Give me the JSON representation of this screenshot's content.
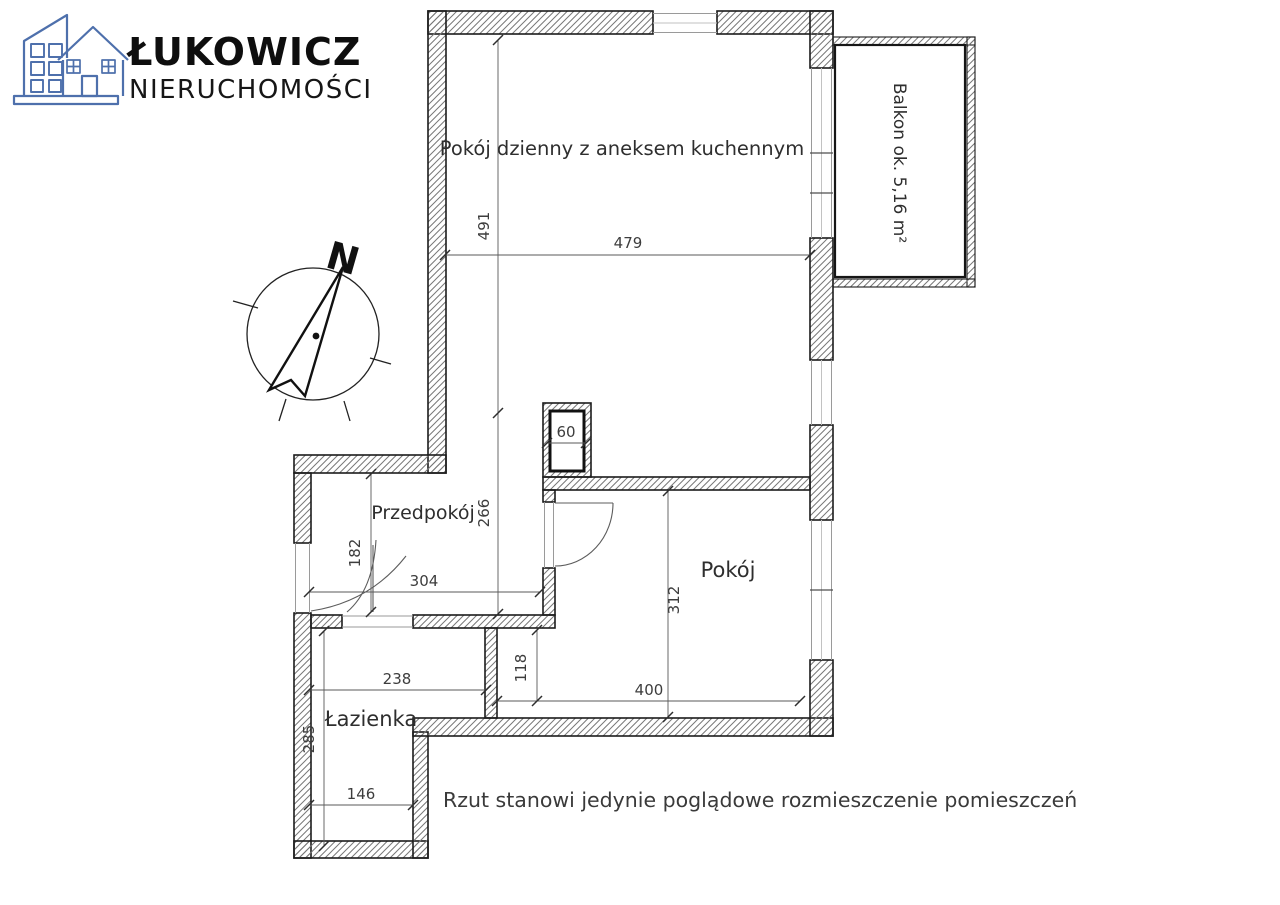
{
  "brand": {
    "name": "ŁUKOWICZ",
    "subtitle": "NIERUCHOMOŚCI"
  },
  "compass": {
    "north_label": "N"
  },
  "plan": {
    "rooms": {
      "living": "Pokój dzienny z aneksem kuchennym",
      "balcony": "Balkon ok. 5,16 m²",
      "hall": "Przedpokój",
      "room": "Pokój",
      "bathroom": "Łazienka"
    },
    "dimensions_cm": {
      "living_depth": "491",
      "living_width": "479",
      "shaft_width": "60",
      "hall_depth": "266",
      "entry_width": "182",
      "hall_width": "304",
      "room_depth": "312",
      "room_nook_depth": "118",
      "room_width": "400",
      "bathroom_width_top": "238",
      "bathroom_depth": "285",
      "bathroom_width_bottom": "146"
    },
    "disclaimer": "Rzut stanowi jedynie poglądowe rozmieszczenie pomieszczeń"
  },
  "colors": {
    "logo_blue": "#4e70ac",
    "wall_outline": "#1c1c1c",
    "hatch_stroke": "#787878",
    "dimension_text": "#3d3d3d"
  }
}
